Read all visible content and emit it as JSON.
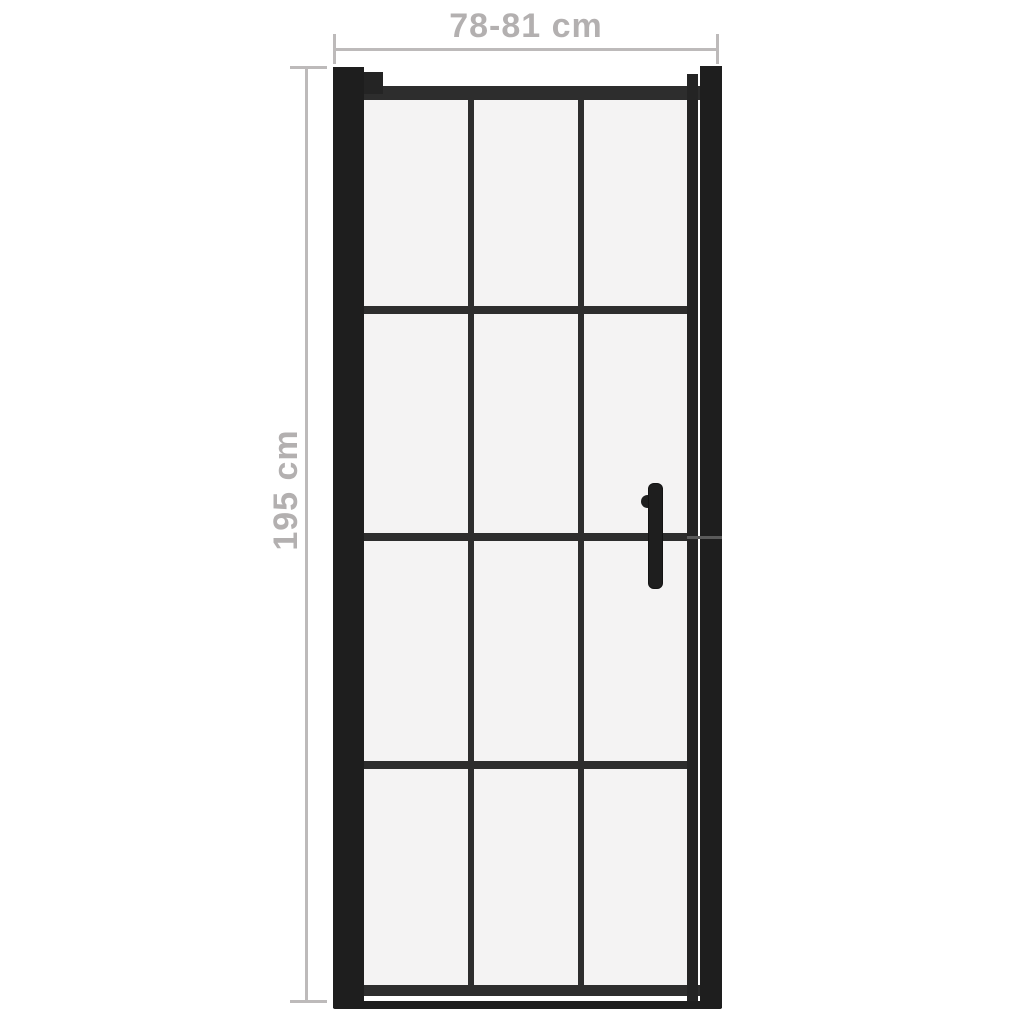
{
  "colors": {
    "background": "#ffffff",
    "frame_dark": "#1e1e1e",
    "frame_mid": "#2d2d2d",
    "stile": "#242424",
    "seam": "#5a5a5a",
    "glass": "#f4f3f3",
    "dim_text": "#b3b0b0",
    "dim_line": "#bdbaba"
  },
  "dimensions": {
    "width_label": "78-81 cm",
    "height_label": "195 cm"
  },
  "door": {
    "glass_columns": 3,
    "glass_rows": 4,
    "handle_side": "right"
  }
}
